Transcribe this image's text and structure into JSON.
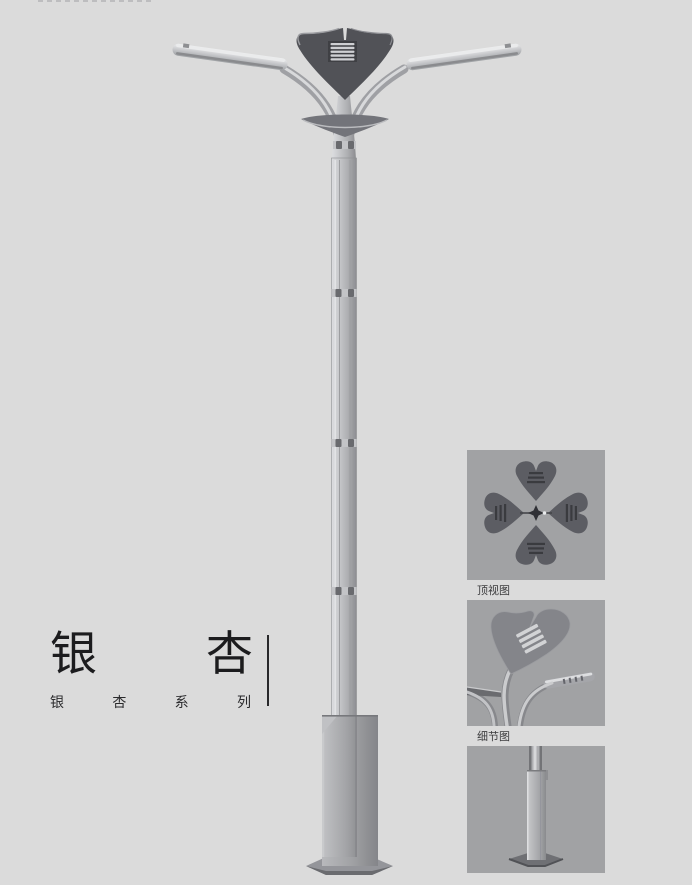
{
  "colors": {
    "page_background": "#dbdbdb",
    "thumbnail_background": "#a1a2a4",
    "metal_light": "#d6d7da",
    "metal_mid": "#b2b3b6",
    "metal_dark": "#8e8f92",
    "lamp_crown_dark": "#515257",
    "title_text": "#1c1c1e",
    "caption_text": "#3c3c3e"
  },
  "title_block": {
    "title": "银杏",
    "title_chars": [
      "银",
      "杏"
    ],
    "subtitle": "银杏系列",
    "subtitle_chars": [
      "银",
      "杏",
      "系",
      "列"
    ]
  },
  "detail_views": [
    {
      "name": "top-view",
      "label": "顶视图"
    },
    {
      "name": "detail-view",
      "label": "细节图"
    },
    {
      "name": "base-view"
    }
  ]
}
